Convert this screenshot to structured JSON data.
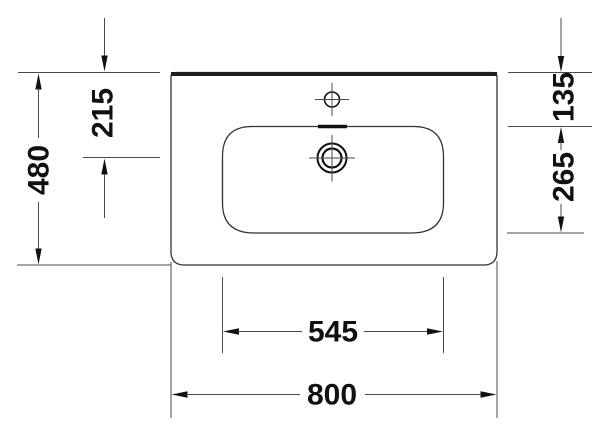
{
  "labels": {
    "overall_depth": "480",
    "tap_hole_from_rear": "215",
    "bowl_offset_rear": "135",
    "bowl_depth": "265",
    "bowl_width": "545",
    "overall_width": "800"
  },
  "colors": {
    "background": "#ffffff",
    "thin_line": "#4a4a4a",
    "ink": "#111111",
    "rear_edge": "#1e1e1e"
  }
}
